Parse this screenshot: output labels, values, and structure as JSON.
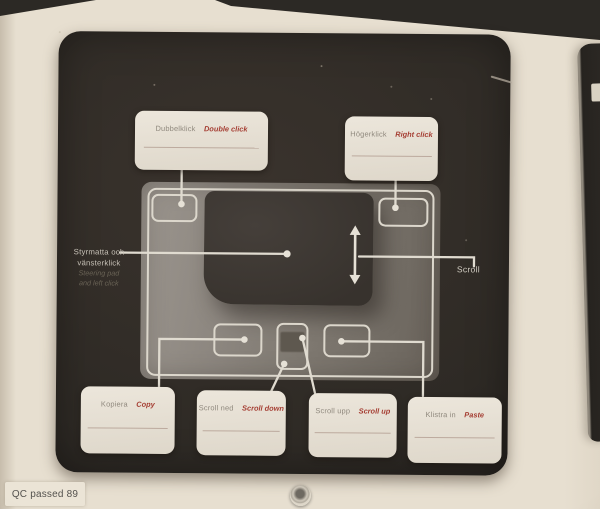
{
  "photo": {
    "qc_sticker": "QC passed 89"
  },
  "colors": {
    "accent_red": "#a53e33",
    "swedish_label_gray": "#8f887d",
    "panel_dark": "#2e2a25",
    "touchpad_gray": "#817b73",
    "leader_line_white": "#e0dbd0",
    "card_background": "#e8e2d6"
  },
  "cards": {
    "double_click": {
      "sv": "Dubbelklick",
      "en": "Double click"
    },
    "right_click": {
      "sv": "Högerklick",
      "en": "Right click"
    },
    "copy": {
      "sv": "Kopiera",
      "en": "Copy"
    },
    "scroll_down": {
      "sv": "Scroll ned",
      "en": "Scroll down"
    },
    "scroll_up": {
      "sv": "Scroll upp",
      "en": "Scroll up"
    },
    "paste": {
      "sv": "Klistra in",
      "en": "Paste"
    }
  },
  "inline_labels": {
    "left_click": {
      "sv_line1": "Styrmatta och",
      "sv_line2": "vänsterklick",
      "en_line1": "Steering pad",
      "en_line2": "and left click"
    },
    "scroll": "Scroll"
  }
}
